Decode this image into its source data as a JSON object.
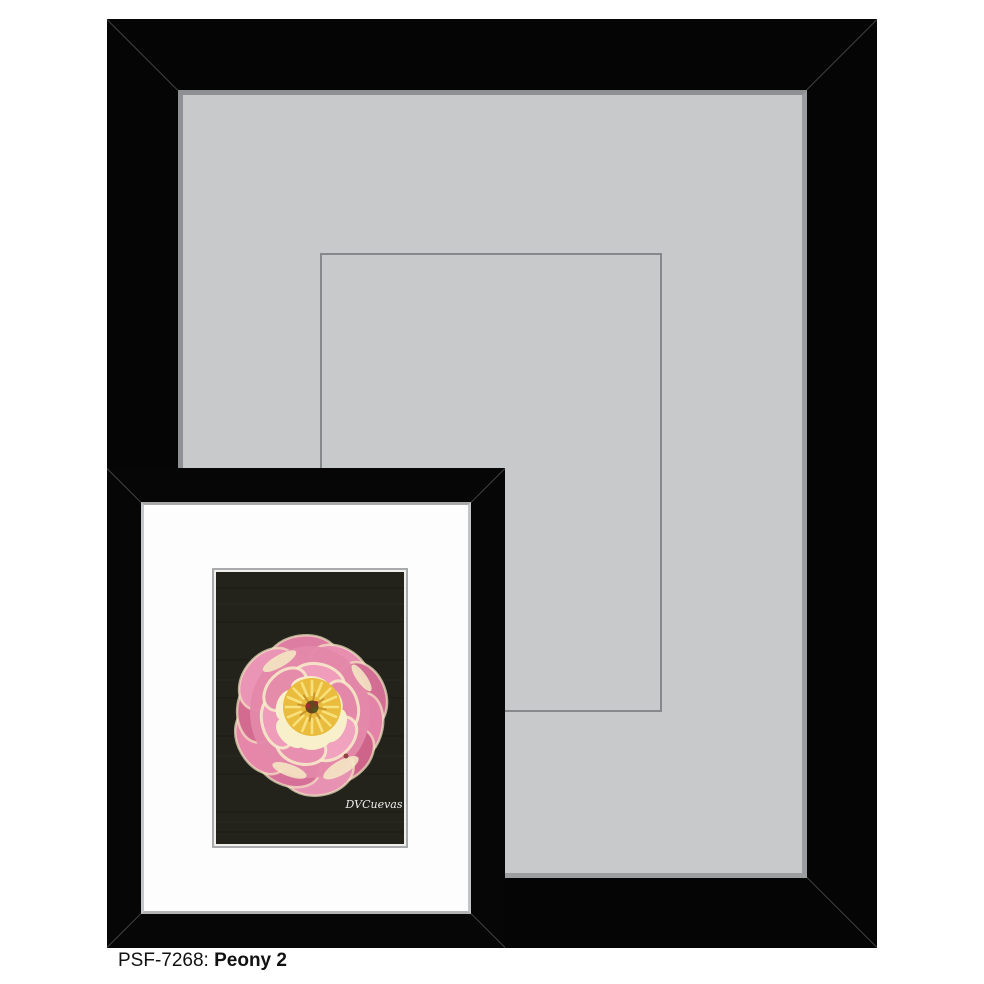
{
  "caption": {
    "sku": "PSF-7268:",
    "title": "Peony 2"
  },
  "artwork": {
    "signature": "DVCuevas"
  },
  "colors": {
    "frame_black": "#050505",
    "outer_mat_gray": "#c8c9cb",
    "mat_bevel_gray": "#8e8f92",
    "opening_outline": "#87888b",
    "inner_mat_white": "#fdfdfd",
    "art_background": "#23231c",
    "petal_pink": "#e388a9",
    "petal_deep_pink": "#cf648b",
    "petal_highlight_cream": "#f8f0cb",
    "flower_center_yellow": "#e9bc3e",
    "page_background": "#ffffff",
    "caption_text": "#111111"
  }
}
